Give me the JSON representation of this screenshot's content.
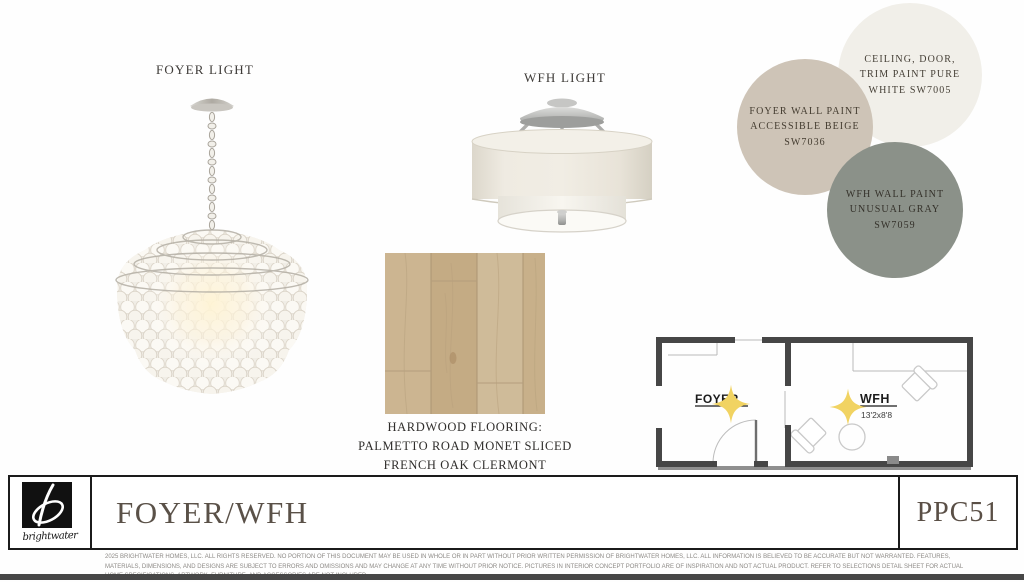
{
  "labels": {
    "foyer_light": "FOYER LIGHT",
    "wfh_light": "WFH LIGHT"
  },
  "flooring": {
    "line1": "HARDWOOD FLOORING:",
    "line2": "PALMETTO ROAD MONET SLICED",
    "line3": "FRENCH OAK CLERMONT"
  },
  "paints": [
    {
      "name": "ceiling-door-trim-paint",
      "lines": [
        "CEILING, DOOR,",
        "TRIM PAINT PURE",
        "WHITE SW7005"
      ],
      "color": "#f1efe9",
      "text_color": "#443e35"
    },
    {
      "name": "foyer-wall-paint",
      "lines": [
        "FOYER WALL PAINT",
        "ACCESSIBLE BEIGE",
        "SW7036"
      ],
      "color": "#cec4b7",
      "text_color": "#443c30"
    },
    {
      "name": "wfh-wall-paint",
      "lines": [
        "WFH WALL PAINT",
        "UNUSUAL GRAY",
        "SW7059"
      ],
      "color": "#8b9189",
      "text_color": "#34312a"
    }
  ],
  "floorplan": {
    "foyer_label": "FOYER",
    "wfh_label": "WFH",
    "wfh_dimensions": "13'2x8'8",
    "star_color": "#f1d362"
  },
  "footer": {
    "brand": "brightwater",
    "title": "FOYER/WFH",
    "code": "PPC51"
  },
  "fine_print": {
    "line1": "2025 BRIGHTWATER HOMES, LLC. ALL RIGHTS RESERVED. NO PORTION OF THIS DOCUMENT MAY BE USED IN WHOLE OR IN PART WITHOUT PRIOR WRITTEN PERMISSION OF BRIGHTWATER HOMES, LLC. ALL INFORMATION IS BELIEVED TO BE ACCURATE BUT NOT WARRANTED. FEATURES,",
    "line2": "MATERIALS, DIMENSIONS, AND DESIGNS ARE SUBJECT TO ERRORS AND OMISSIONS AND MAY CHANGE AT ANY TIME WITHOUT PRIOR NOTICE. PICTURES IN INTERIOR CONCEPT PORTFOLIO ARE OF INSPIRATION AND NOT ACTUAL PRODUCT. REFER TO SELECTIONS DETAIL SHEET FOR ACTUAL",
    "line3": "HOME SPECIFICATIONS. ARTWORK, FURNITURE, AND ACCESSORIES ARE NOT INCLUDED."
  }
}
